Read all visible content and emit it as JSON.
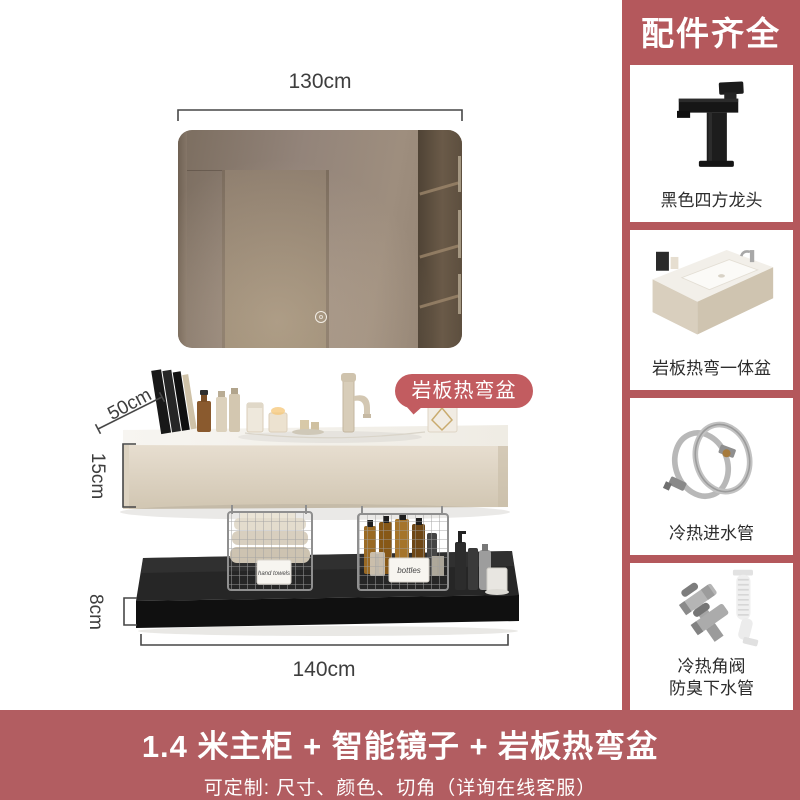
{
  "page": {
    "type": "ecommerce-product-detail-image"
  },
  "colors": {
    "sidebar_bg": "#b4585c",
    "banner_bg": "#b25d61",
    "badge_bg": "#c25c60",
    "card_bg": "#ffffff",
    "dimension_text": "#3e3e3e",
    "counter_beige": "#d9cfbd",
    "shelf_black": "#161616",
    "mirror_brown": "#8f8072"
  },
  "main": {
    "dims": {
      "mirror_width": "130cm",
      "counter_depth": "50cm",
      "counter_height": "15cm",
      "shelf_height": "8cm",
      "cabinet_width": "140cm"
    },
    "badge_label": "岩板热弯盆",
    "basket_tags": {
      "left": "hand towels",
      "right": "bottles"
    }
  },
  "sidebar": {
    "header": "配件齐全",
    "cards": [
      {
        "icon": "black-square-faucet",
        "label": "黑色四方龙头"
      },
      {
        "icon": "slate-one-piece-basin",
        "label": "岩板热弯一体盆"
      },
      {
        "icon": "braided-inlet-hoses",
        "label": "冷热进水管"
      },
      {
        "icon": "angle-valves-drain-pipe",
        "label": "冷热角阀",
        "label2": "防臭下水管"
      }
    ]
  },
  "banner": {
    "title": "1.4 米主柜 + 智能镜子 + 岩板热弯盆",
    "subtitle": "可定制: 尺寸、颜色、切角（详询在线客服）"
  }
}
